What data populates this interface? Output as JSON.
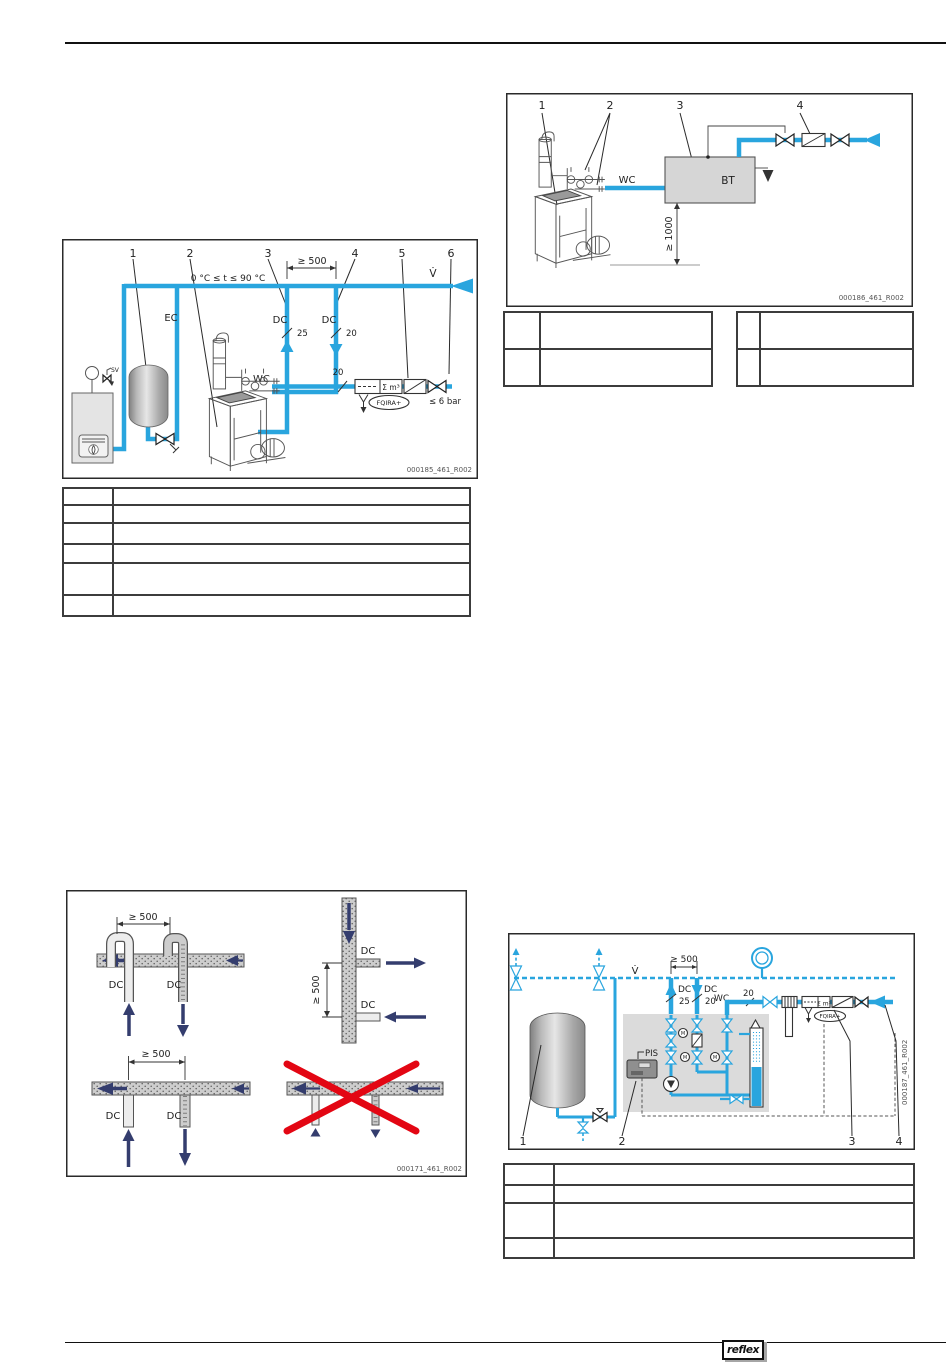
{
  "footer": {
    "logo_text": "reflex"
  },
  "d1": {
    "callouts": [
      "1",
      "2",
      "3",
      "4",
      "5",
      "6"
    ],
    "temp_range": "0 °C ≤ t ≤ 90 °C",
    "dim_500": "≥ 500",
    "flow_symbol": "V̇",
    "ec": "EC",
    "dc_left": "DC",
    "dc_right": "DC",
    "dn25": "25",
    "dn20": "20",
    "wc": "WC",
    "dn20_meter": "20",
    "meter": "Σ m³",
    "fqira": "FQIRA+",
    "max_pressure": "≤ 6 bar",
    "sv": "SV",
    "code": "000185_461_R002"
  },
  "d2": {
    "callouts": [
      "1",
      "2",
      "3",
      "4"
    ],
    "wc": "WC",
    "bt": "BT",
    "dim_1000": "≥ 1000",
    "code": "000186_461_R002"
  },
  "d3": {
    "dim_a": "≥ 500",
    "dim_b": "≥ 500",
    "dim_c": "≥ 500",
    "dc_a1": "DC",
    "dc_a2": "DC",
    "dc_b1": "DC",
    "dc_b2": "DC",
    "dc_c1": "DC",
    "dc_c2": "DC",
    "code": "000171_461_R002"
  },
  "d4": {
    "callouts": [
      "1",
      "2",
      "3",
      "4"
    ],
    "flow_symbol": "V̇",
    "dim_500": "≥ 500",
    "dc_left": "DC",
    "dc_right": "DC",
    "dn25": "25",
    "dn20": "20",
    "wc": "WC",
    "dn20_meter": "20",
    "pis": "PIS",
    "valve_motor": "M",
    "meter": "Σ m³",
    "fqira": "FQIRA+",
    "code": "000187_461_R002"
  }
}
